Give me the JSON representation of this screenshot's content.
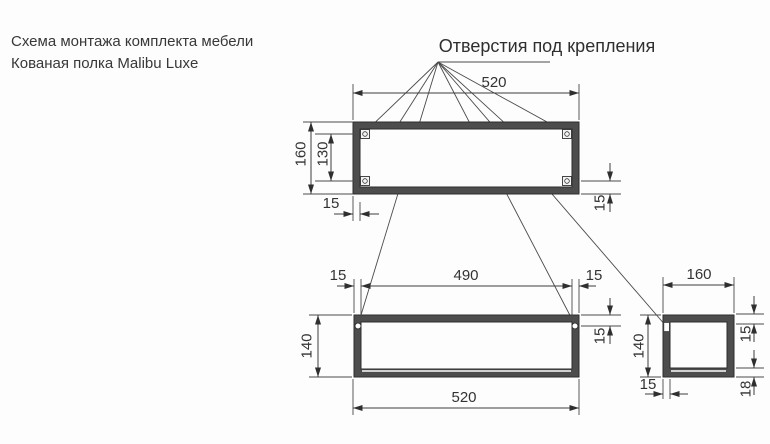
{
  "title": {
    "line1": "Схема монтажа комплекта мебели",
    "line2": "Кованая полка Malibu Luxe"
  },
  "callout": {
    "label": "Отверстия под крепления"
  },
  "top_view": {
    "width": "520",
    "height": "160",
    "hole_span": "130",
    "offset_left": "15",
    "offset_right": "15"
  },
  "front_view": {
    "offset_left": "15",
    "hole_span": "490",
    "offset_right": "15",
    "height": "140",
    "hole_offset": "15",
    "width": "520"
  },
  "side_view": {
    "width": "160",
    "height": "140",
    "wall_top": "15",
    "wall_bottom": "18",
    "wall_left": "15"
  },
  "colors": {
    "frame_fill": "#4d4d4d",
    "line": "#3d3d3d",
    "text": "#333333",
    "background": "#fdfdfd"
  }
}
